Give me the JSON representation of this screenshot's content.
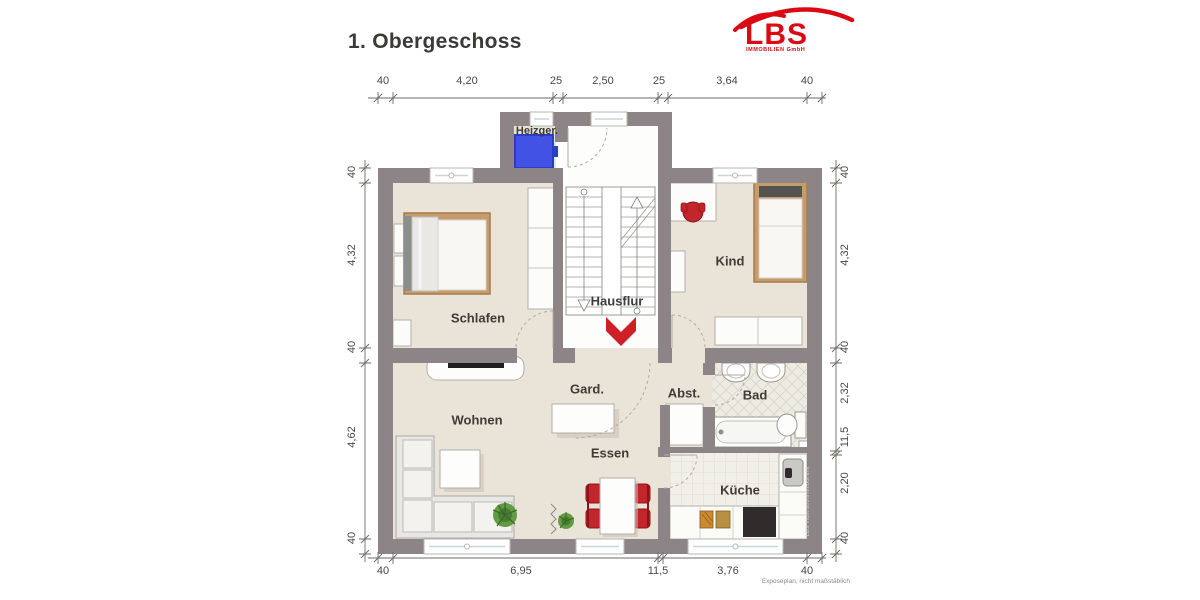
{
  "title": "1. Obergeschoss",
  "logo": {
    "brand": "LBS",
    "subtitle": "IMMOBILIEN GmbH"
  },
  "footer_note": "Exposéplan, nicht maßstäblich",
  "watermark": "LBS IllustrationImmoGrafik",
  "rooms": {
    "heizger": "Heizger.",
    "schlafen": "Schlafen",
    "kind": "Kind",
    "hausflur": "Hausflur",
    "gard": "Gard.",
    "wohnen": "Wohnen",
    "essen": "Essen",
    "abst": "Abst.",
    "bad": "Bad",
    "kueche": "Küche"
  },
  "dimensions": {
    "top": [
      "40",
      "4,20",
      "25",
      "2,50",
      "25",
      "3,64",
      "40"
    ],
    "bottom": [
      "40",
      "6,95",
      "11,5",
      "3,76",
      "40"
    ],
    "left": [
      "40",
      "4,32",
      "40",
      "4,62",
      "40"
    ],
    "right": [
      "40",
      "4,32",
      "40",
      "2,32",
      "11,5",
      "2,20",
      "40"
    ]
  },
  "colors": {
    "wall": "#8d8487",
    "floor": "#eae4d8",
    "hall_floor": "#fdfdfc",
    "accent_red": "#ce2127",
    "logo_red": "#da0a15",
    "heater_blue": "#4152e4"
  }
}
